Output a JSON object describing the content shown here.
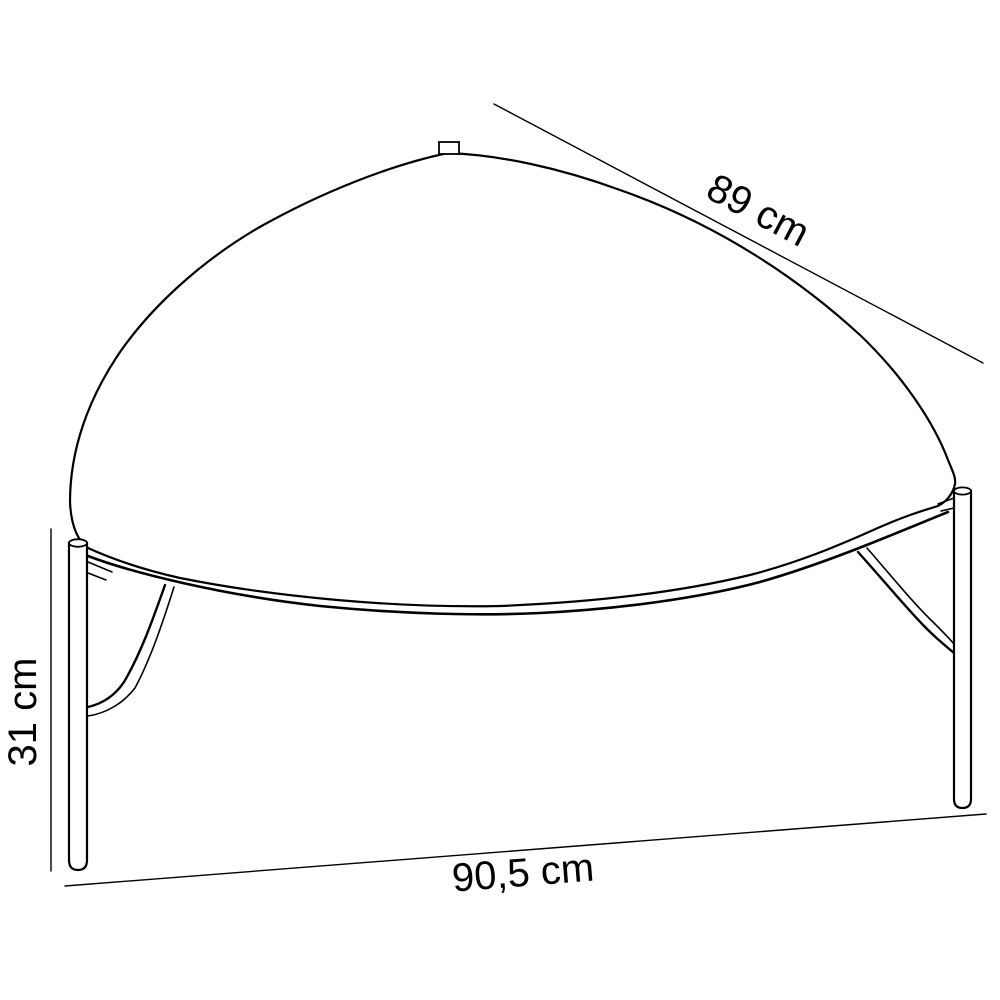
{
  "colors": {
    "background": "#ffffff",
    "line": "#000000",
    "text": "#000000"
  },
  "diagram": {
    "dimensions": {
      "depth": {
        "label": "89 cm"
      },
      "height": {
        "label": "31 cm"
      },
      "width": {
        "label": "90,5 cm"
      }
    }
  }
}
